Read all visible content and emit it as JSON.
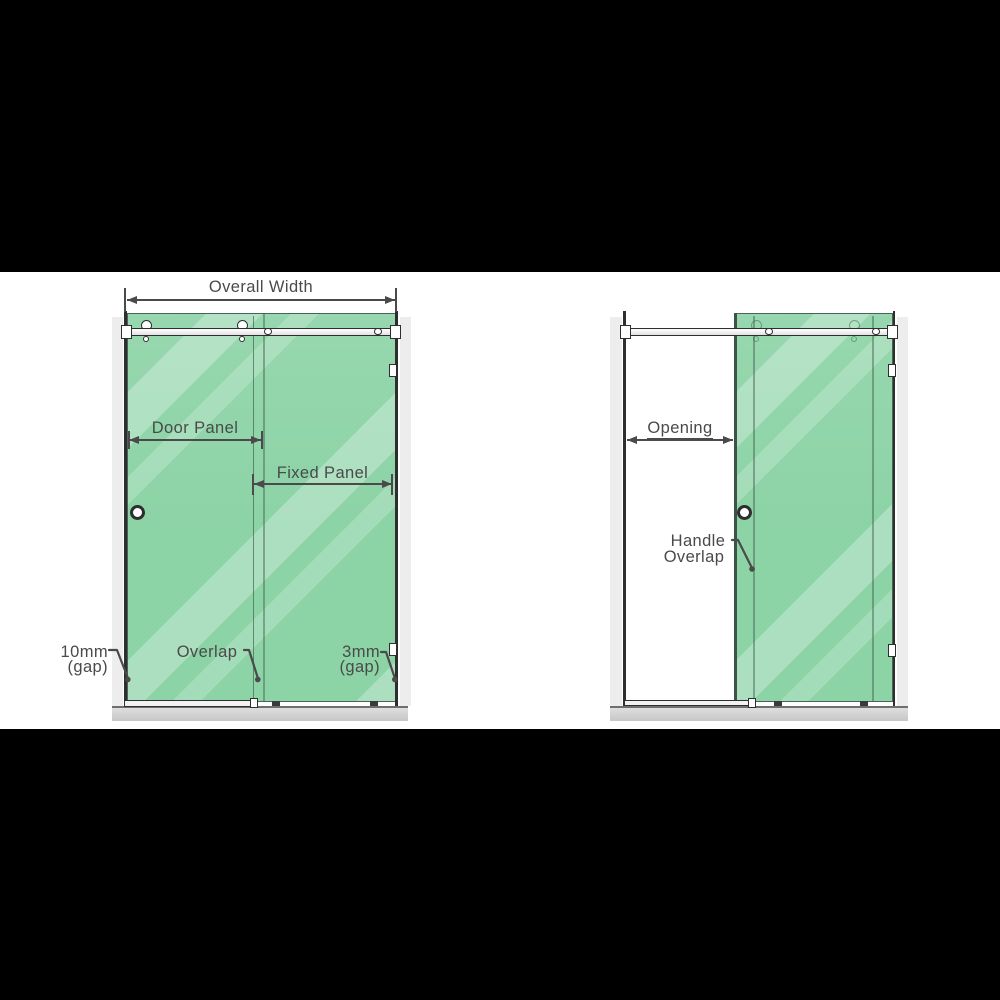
{
  "theme": {
    "letterbox": "#000000",
    "canvas": "#ffffff",
    "glass": "#8cd3a6",
    "strip": "#ededed",
    "wall": "#2e2e2e",
    "tray": "#d2d2d2",
    "ink": "#4a4a4a"
  },
  "left_diagram": {
    "overall_width_label": "Overall Width",
    "door_panel_label": "Door Panel",
    "fixed_panel_label": "Fixed Panel",
    "left_gap_label": [
      "10mm",
      "(gap)"
    ],
    "overlap_label": "Overlap",
    "right_gap_label": [
      "3mm",
      "(gap)"
    ]
  },
  "right_diagram": {
    "opening_label": "Opening",
    "handle_overlap_label": [
      "Handle",
      "Overlap"
    ]
  }
}
